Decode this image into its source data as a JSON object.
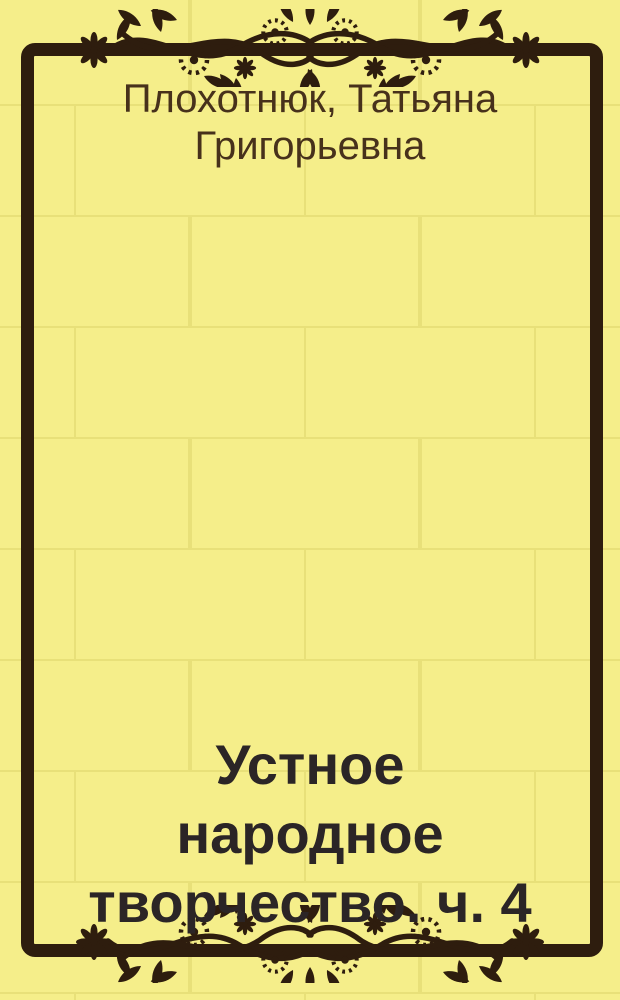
{
  "cover": {
    "author": "Плохотнюк, Татьяна Григорьевна",
    "author_lines": [
      "Плохотнюк, Татьяна",
      "Григорьевна"
    ],
    "title": "Устное народное творчество. ч. 4",
    "title_lines": [
      "Устное",
      "народное",
      "творчество. ч. 4"
    ],
    "icons": {
      "top_ornament": "floral-vine-ornament",
      "bottom_ornament": "floral-vine-ornament"
    },
    "colors": {
      "background": "#f5ee8a",
      "tile_seam": "#e8e079",
      "frame": "#2e1d0e",
      "ornament": "#2e1d0e",
      "author_text": "#47311b",
      "title_text": "#2b2526"
    }
  }
}
